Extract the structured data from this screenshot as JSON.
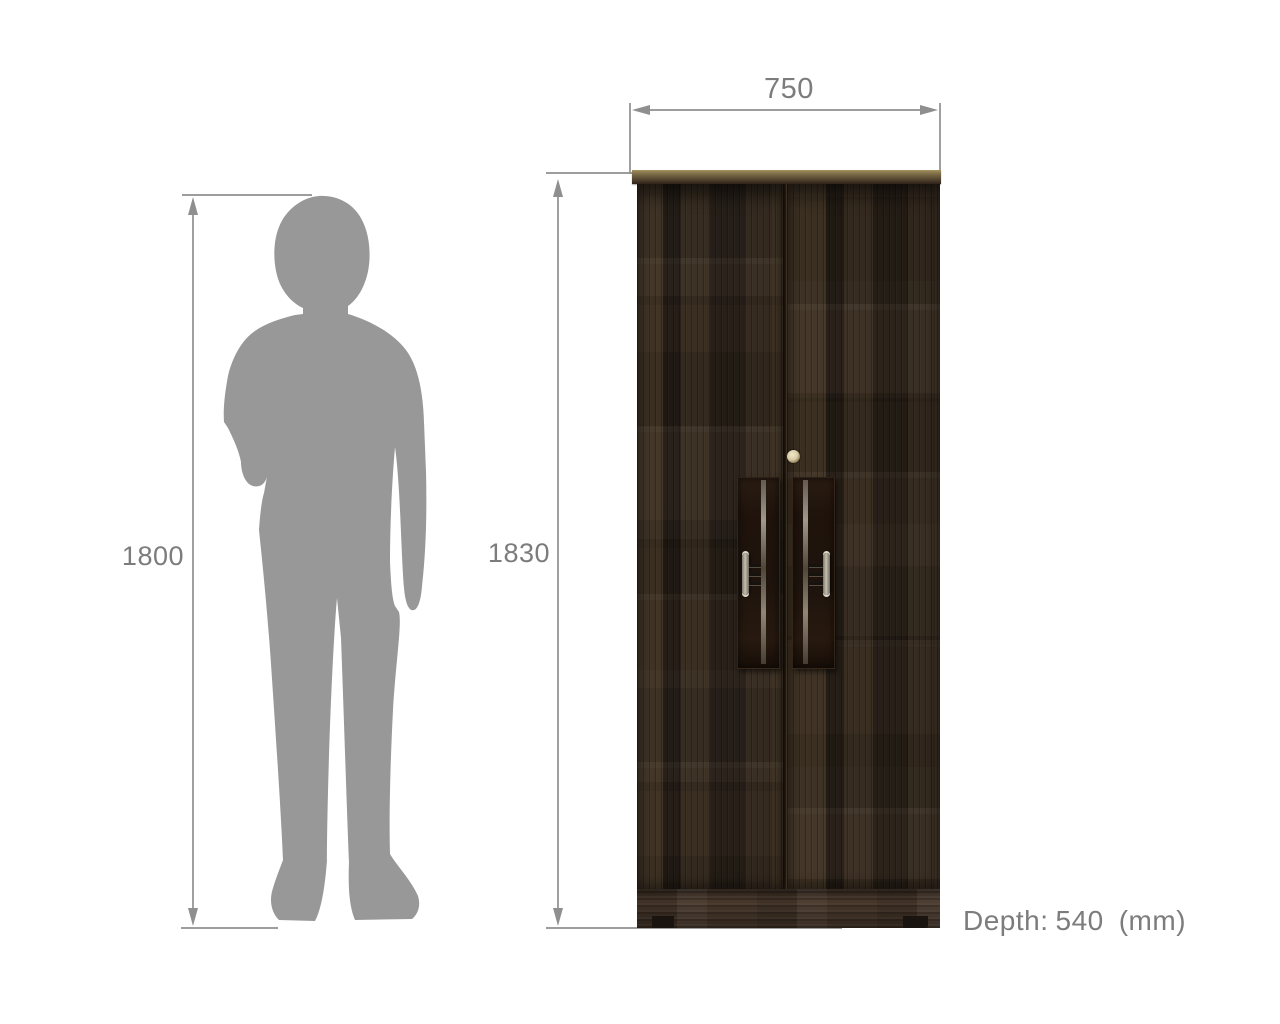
{
  "diagram": {
    "person": {
      "height_label": "1800"
    },
    "wardrobe": {
      "width_label": "750",
      "height_label": "1830"
    },
    "depth_note": {
      "prefix": "Depth:",
      "value": "540",
      "unit": "(mm)"
    },
    "style": {
      "background": "#ffffff",
      "dimension_line_color": "#8f8f8f",
      "label_color": "#7c7c7c",
      "silhouette_color": "#989898",
      "wood_color": "#31271e",
      "top_board_color": "#6d5e3f",
      "base_color": "#47372a",
      "lock_color": "#d8cda8",
      "handle_metal_color": "#c6beae",
      "handle_plate_color": "#1e140d"
    }
  }
}
